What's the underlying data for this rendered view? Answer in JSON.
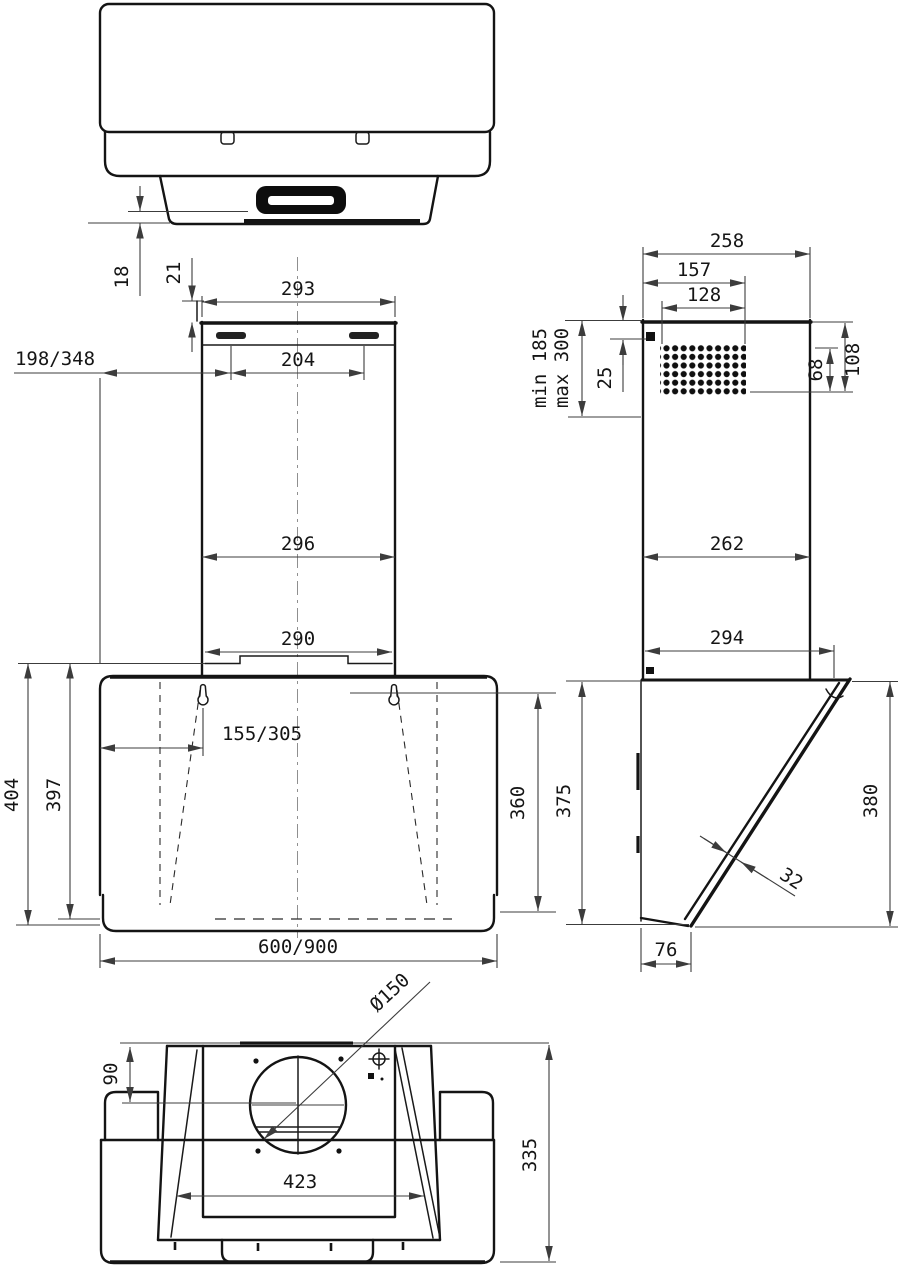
{
  "drawing": {
    "type": "technical-dimension-drawing",
    "subject": "Wall-mounted angled cooker hood, orthographic views with dimensions",
    "units": "mm",
    "colors": {
      "outline": "#141414",
      "dimension": "#3c3c3c",
      "background": "#ffffff"
    },
    "views": {
      "top": {
        "label": "top-view",
        "dims": {
          "d18": "18",
          "d21": "21"
        }
      },
      "front": {
        "label": "front-view",
        "dims": {
          "d293": "293",
          "d204": "204",
          "d198_348": "198/348",
          "d296": "296",
          "d290": "290",
          "d155_305": "155/305",
          "d404": "404",
          "d397": "397",
          "d360": "360",
          "d600_900": "600/900"
        }
      },
      "side": {
        "label": "side-view",
        "dims": {
          "d258": "258",
          "d157": "157",
          "d128": "128",
          "dmin185": "min 185",
          "dmax300": "max 300",
          "d25": "25",
          "d68": "68",
          "d108": "108",
          "d262": "262",
          "d294": "294",
          "d375": "375",
          "d380": "380",
          "d32": "32",
          "d76": "76"
        }
      },
      "bottom": {
        "label": "bottom-view",
        "dims": {
          "d150": "Ø150",
          "d90": "90",
          "d423": "423",
          "d335": "335"
        }
      }
    }
  }
}
